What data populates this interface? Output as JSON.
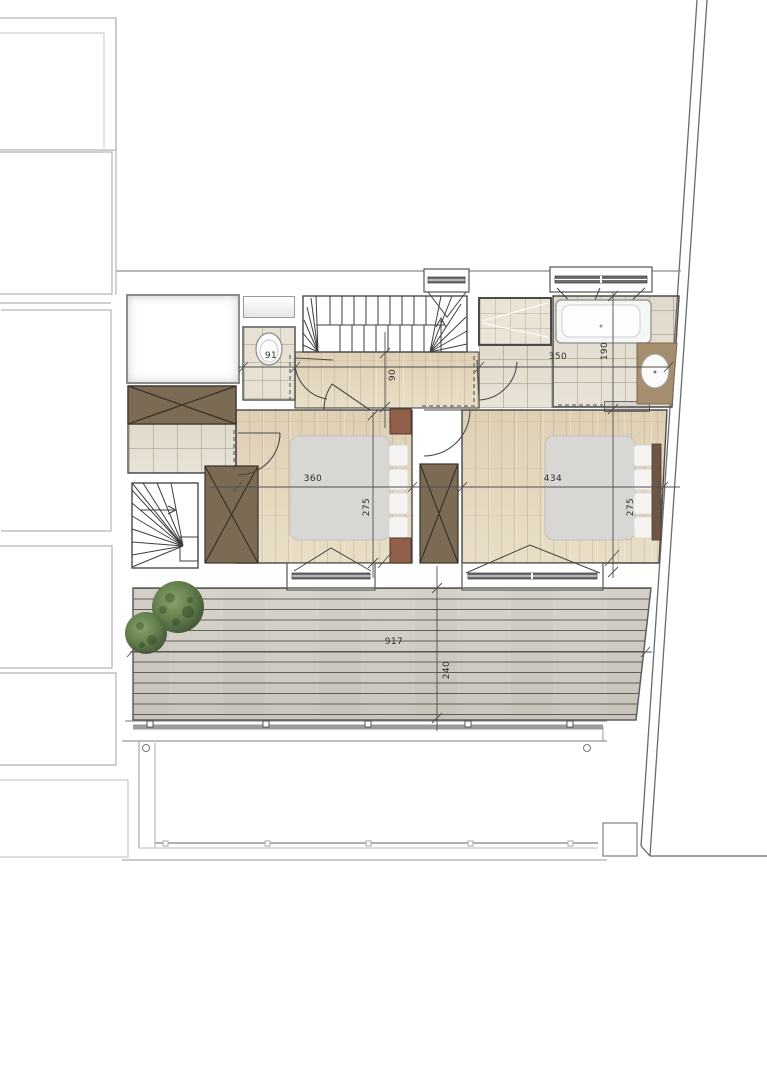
{
  "document": {
    "kind": "architectural floor plan",
    "units": "cm"
  },
  "dimensions": {
    "wc_width": "91",
    "hallway_width": "90",
    "bathroom_width": "350",
    "bathroom_depth": "190",
    "bedroom_left_width": "360",
    "bedroom_left_depth": "275",
    "bedroom_right_width": "434",
    "bedroom_right_depth": "275",
    "terrace_width": "917",
    "terrace_depth": "240"
  },
  "colors": {
    "wood_floor": "#e9dfc9",
    "tile_floor": "#e7e2d5",
    "terrace_plank": "#dbd6cd",
    "wardrobe": "#7b6b55",
    "vanity_counter": "#a68d6e",
    "bed_duvet": "#d9d7d3",
    "nightstand": "#91604a",
    "headboard": "#6e5645",
    "bush_green": "#5d7a49",
    "wall_line": "#4a4a4a",
    "neighbor_outline": "#b5b5b5"
  }
}
